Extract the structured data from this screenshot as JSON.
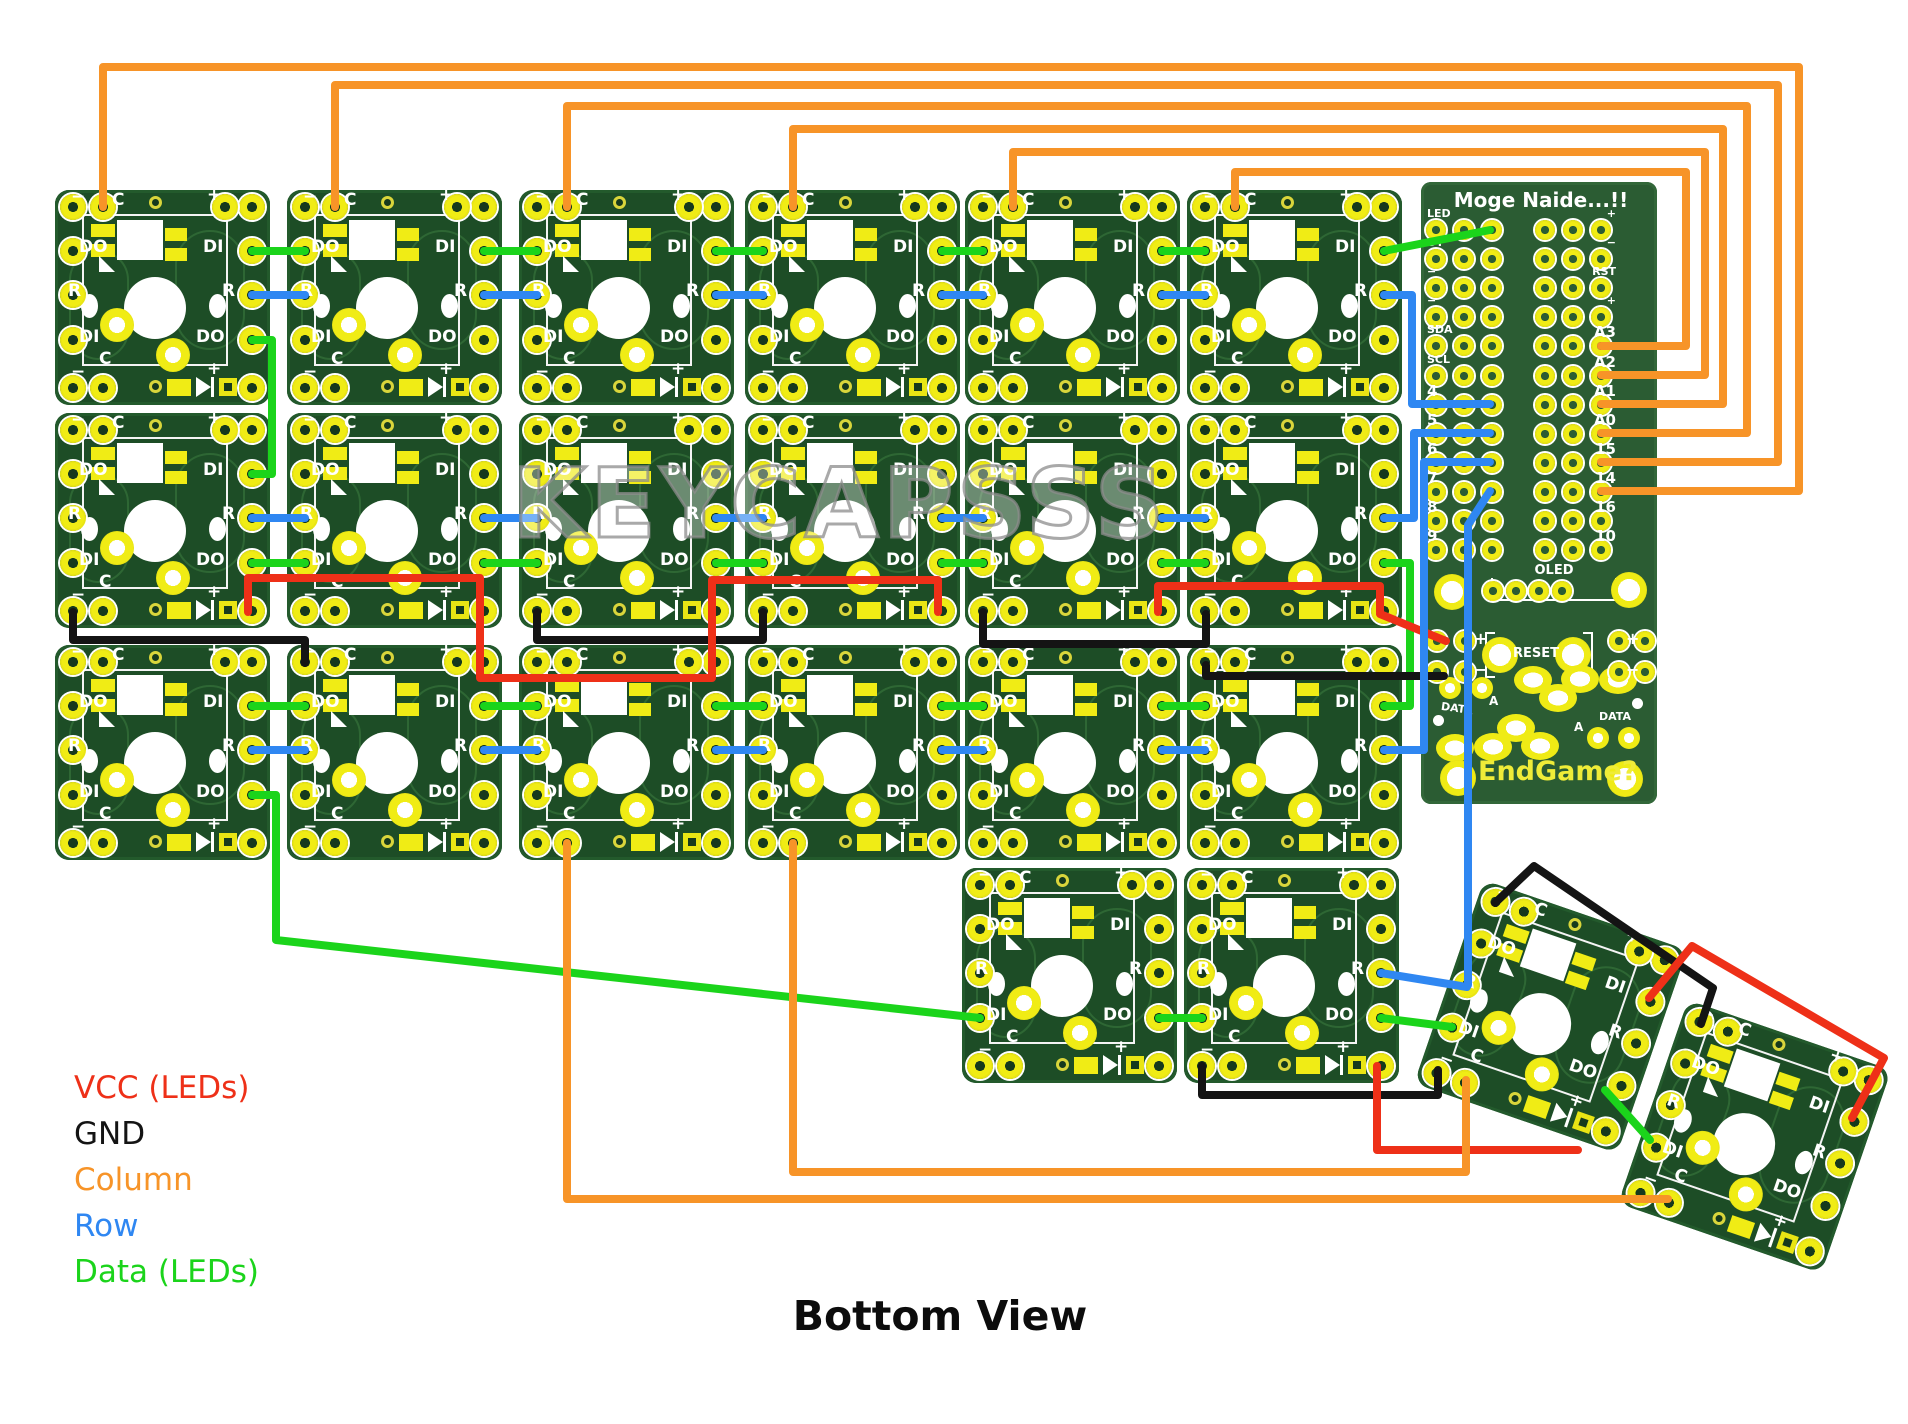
{
  "title": "Bottom View",
  "watermark": "KEYCAPSSS",
  "legend": [
    {
      "net": "vcc",
      "label": "VCC (LEDs)",
      "color": "#ee3018"
    },
    {
      "net": "gnd",
      "label": "GND",
      "color": "#141414"
    },
    {
      "net": "column",
      "label": "Column",
      "color": "#f79428"
    },
    {
      "net": "row",
      "label": "Row",
      "color": "#2f87f2"
    },
    {
      "net": "data",
      "label": "Data (LEDs)",
      "color": "#1bd41b"
    }
  ],
  "module": {
    "labels": {
      "minus": "−",
      "c": "C",
      "plus": "+",
      "do": "DO",
      "di": "DI",
      "r": "R"
    }
  },
  "controller": {
    "title": "Moge Naide...!!",
    "left_pins": [
      "LED",
      "DT",
      "−",
      "−",
      "SDA",
      "SCL",
      "4",
      "5",
      "6",
      "7",
      "8",
      "9"
    ],
    "right_pins": [
      "+",
      "−",
      "RST",
      "+",
      "A3",
      "A2",
      "A1",
      "A0",
      "15",
      "14",
      "16",
      "10"
    ],
    "oled_label": "OLED",
    "reset_label": "RESET",
    "plus_label": "+",
    "minus_label": "−",
    "data_label_left": "DATA",
    "a_label_left": "A",
    "a_label_right": "A",
    "data_label_right": "DATA",
    "endgame_label": "EndGame?"
  }
}
